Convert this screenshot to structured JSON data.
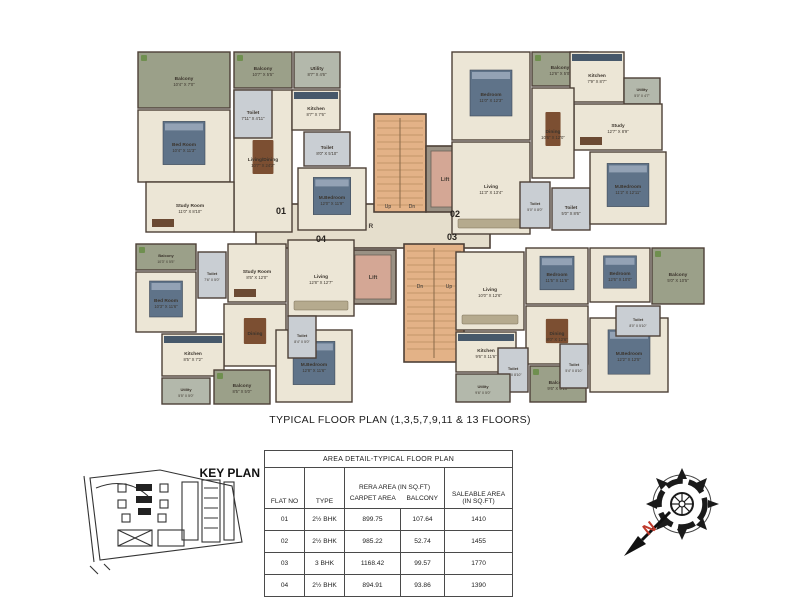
{
  "caption": "TYPICAL FLOOR PLAN (1,3,5,7,9,11 & 13 FLOORS)",
  "key_plan": {
    "title": "KEY PLAN"
  },
  "compass": {
    "letter": "N"
  },
  "table": {
    "title": "AREA DETAIL-TYPICAL FLOOR PLAN",
    "col_flat_no": "FLAT NO",
    "col_type": "TYPE",
    "col_rera": "RERA AREA (IN SQ.FT)",
    "col_carpet": "CARPET AREA",
    "col_balcony": "BALCONY",
    "col_saleable": "SALEABLE AREA (IN SQ.FT)",
    "rows": [
      {
        "flat_no": "01",
        "type": "2½ BHK",
        "carpet_area": "899.75",
        "balcony": "107.64",
        "saleable": "1410"
      },
      {
        "flat_no": "02",
        "type": "2½ BHK",
        "carpet_area": "985.22",
        "balcony": "52.74",
        "saleable": "1455"
      },
      {
        "flat_no": "03",
        "type": "3 BHK",
        "carpet_area": "1168.42",
        "balcony": "99.57",
        "saleable": "1770"
      },
      {
        "flat_no": "04",
        "type": "2½ BHK",
        "carpet_area": "894.91",
        "balcony": "93.86",
        "saleable": "1390"
      }
    ]
  },
  "colors": {
    "floor": "#ece6d6",
    "balcony": "#9ba089",
    "toilet": "#c9ced3",
    "utility": "#b3b8ab",
    "stairs": "#e3b287",
    "lift": "#d4a795",
    "lift_frame": "#9a9184",
    "wall": "#4d4037",
    "corridor": "#e5decc",
    "bed": "#5f7389",
    "pillow": "#93a2b5",
    "table": "#7c4f32",
    "counter": "#46586a",
    "sofa": "#b5aa8e",
    "desk": "#6b4a33",
    "plant": "#6f8f4f",
    "label": "#3b342c",
    "accent_red": "#c03a2b"
  },
  "plan": {
    "core": {
      "corridor": {
        "x": 256,
        "y": 204,
        "w": 234,
        "h": 44,
        "label": "CORRIDOR"
      },
      "stairs": [
        {
          "x": 374,
          "y": 114,
          "w": 52,
          "h": 98,
          "up": {
            "x": 388,
            "y": 208,
            "t": "Up"
          },
          "dn": {
            "x": 412,
            "y": 208,
            "t": "Dn"
          }
        },
        {
          "x": 404,
          "y": 244,
          "w": 60,
          "h": 118,
          "dn": {
            "x": 420,
            "y": 288,
            "t": "Dn"
          },
          "up": {
            "x": 449,
            "y": 288,
            "t": "Up"
          }
        }
      ],
      "lifts": [
        {
          "x": 426,
          "y": 146,
          "w": 38,
          "h": 66,
          "label": "Lift"
        },
        {
          "x": 350,
          "y": 250,
          "w": 46,
          "h": 54,
          "label": "Lift"
        }
      ]
    },
    "flats": [
      {
        "number": "01",
        "label_x": 281,
        "label_y": 214,
        "rooms": [
          {
            "name": "Living/Dining",
            "dims": "10'7\" X 24'2\"",
            "type": "floor",
            "furn": "table",
            "x": 234,
            "y": 90,
            "w": 58,
            "h": 142
          },
          {
            "name": "Balcony",
            "dims": "10'4\" X 7'0\"",
            "type": "balcony",
            "furn": null,
            "x": 138,
            "y": 52,
            "w": 92,
            "h": 56
          },
          {
            "name": "Balcony",
            "dims": "10'7\" X 5'5\"",
            "type": "balcony",
            "furn": null,
            "x": 234,
            "y": 52,
            "w": 58,
            "h": 36
          },
          {
            "name": "Utility",
            "dims": "8'7\" X 4'6\"",
            "type": "utility",
            "furn": null,
            "x": 294,
            "y": 52,
            "w": 46,
            "h": 36
          },
          {
            "name": "Kitchen",
            "dims": "8'7\" X 7'6\"",
            "type": "floor",
            "furn": "counter",
            "x": 292,
            "y": 90,
            "w": 48,
            "h": 40
          },
          {
            "name": "Toilet",
            "dims": "7'11\" X 4'11\"",
            "type": "toilet",
            "furn": null,
            "x": 234,
            "y": 90,
            "w": 38,
            "h": 48
          },
          {
            "name": "Bed Room",
            "dims": "10'4\" X 11'3\"",
            "type": "floor",
            "furn": "bed",
            "x": 138,
            "y": 110,
            "w": 92,
            "h": 72
          },
          {
            "name": "Study Room",
            "dims": "11'0\" X 8'10\"",
            "type": "floor",
            "furn": "desk",
            "x": 146,
            "y": 182,
            "w": 88,
            "h": 50
          },
          {
            "name": "Toilet",
            "dims": "8'0\" X 5'10\"",
            "type": "toilet",
            "furn": null,
            "x": 304,
            "y": 132,
            "w": 46,
            "h": 34
          },
          {
            "name": "M.Bedroom",
            "dims": "12'0\" X 11'9\"",
            "type": "floor",
            "furn": "bed",
            "x": 298,
            "y": 168,
            "w": 68,
            "h": 62
          }
        ]
      },
      {
        "number": "02",
        "label_x": 455,
        "label_y": 217,
        "rooms": [
          {
            "name": "Bedroom",
            "dims": "11'0\" X 12'3\"",
            "type": "floor",
            "furn": "bed",
            "x": 452,
            "y": 52,
            "w": 78,
            "h": 88
          },
          {
            "name": "Balcony",
            "dims": "12'6\" X 5'0\"",
            "type": "balcony",
            "furn": null,
            "x": 532,
            "y": 52,
            "w": 56,
            "h": 34
          },
          {
            "name": "Kitchen",
            "dims": "7'9\" X 8'7\"",
            "type": "floor",
            "furn": "counter",
            "x": 570,
            "y": 52,
            "w": 54,
            "h": 50
          },
          {
            "name": "Utility",
            "dims": "5'0\" X 4'7\"",
            "type": "utility",
            "furn": null,
            "x": 624,
            "y": 78,
            "w": 36,
            "h": 26
          },
          {
            "name": "Study",
            "dims": "12'7\" X 8'9\"",
            "type": "floor",
            "furn": "desk",
            "x": 574,
            "y": 104,
            "w": 88,
            "h": 46
          },
          {
            "name": "Dining",
            "dims": "10'6\" X 12'0\"",
            "type": "floor",
            "furn": "table",
            "x": 532,
            "y": 88,
            "w": 42,
            "h": 90
          },
          {
            "name": "Living",
            "dims": "11'3\" X 13'4\"",
            "type": "floor",
            "furn": "sofa",
            "x": 452,
            "y": 142,
            "w": 78,
            "h": 92
          },
          {
            "name": "Toilet",
            "dims": "5'0\" X 8'0\"",
            "type": "toilet",
            "furn": null,
            "x": 520,
            "y": 182,
            "w": 30,
            "h": 46
          },
          {
            "name": "Toilet",
            "dims": "5'0\" X 8'6\"",
            "type": "toilet",
            "furn": null,
            "x": 552,
            "y": 188,
            "w": 38,
            "h": 42
          },
          {
            "name": "M.Bedroom",
            "dims": "11'2\" X 12'11\"",
            "type": "floor",
            "furn": "bed",
            "x": 590,
            "y": 152,
            "w": 76,
            "h": 72
          }
        ]
      },
      {
        "number": "03",
        "label_x": 452,
        "label_y": 240,
        "rooms": [
          {
            "name": "Living",
            "dims": "10'0\" X 12'6\"",
            "type": "floor",
            "furn": "sofa",
            "x": 456,
            "y": 252,
            "w": 68,
            "h": 78
          },
          {
            "name": "Bedroom",
            "dims": "11'5\" X 11'6\"",
            "type": "floor",
            "furn": "bed",
            "x": 526,
            "y": 248,
            "w": 62,
            "h": 56
          },
          {
            "name": "Bedroom",
            "dims": "12'6\" X 10'0\"",
            "type": "floor",
            "furn": "bed",
            "x": 590,
            "y": 248,
            "w": 60,
            "h": 54
          },
          {
            "name": "Balcony",
            "dims": "5'0\" X 10'5\"",
            "type": "balcony",
            "furn": null,
            "x": 652,
            "y": 248,
            "w": 52,
            "h": 56
          },
          {
            "name": "Dining",
            "dims": "8'0\" X 12'6\"",
            "type": "floor",
            "furn": "table",
            "x": 526,
            "y": 306,
            "w": 62,
            "h": 58
          },
          {
            "name": "M.Bedroom",
            "dims": "12'2\" X 12'5\"",
            "type": "floor",
            "furn": "bed",
            "x": 590,
            "y": 318,
            "w": 78,
            "h": 74
          },
          {
            "name": "Toilet",
            "dims": "8'0\" X 5'10\"",
            "type": "toilet",
            "furn": null,
            "x": 616,
            "y": 306,
            "w": 44,
            "h": 30
          },
          {
            "name": "Kitchen",
            "dims": "9'6\" X 11'6\"",
            "type": "floor",
            "furn": "counter",
            "x": 456,
            "y": 332,
            "w": 60,
            "h": 40
          },
          {
            "name": "Toilet",
            "dims": "5'0\" X 8'10\"",
            "type": "toilet",
            "furn": null,
            "x": 498,
            "y": 348,
            "w": 30,
            "h": 44
          },
          {
            "name": "Utility",
            "dims": "9'6\" X 5'0\"",
            "type": "utility",
            "furn": null,
            "x": 456,
            "y": 374,
            "w": 54,
            "h": 28
          },
          {
            "name": "Balcony",
            "dims": "9'6\" X 5'10\"",
            "type": "balcony",
            "furn": null,
            "x": 530,
            "y": 366,
            "w": 56,
            "h": 36
          },
          {
            "name": "Toilet",
            "dims": "5'4\" X 8'10\"",
            "type": "toilet",
            "furn": null,
            "x": 560,
            "y": 344,
            "w": 28,
            "h": 44
          }
        ]
      },
      {
        "number": "04",
        "label_x": 321,
        "label_y": 242,
        "rooms": [
          {
            "name": "Living",
            "dims": "12'8\" X 12'7\"",
            "type": "floor",
            "furn": "sofa",
            "x": 288,
            "y": 240,
            "w": 66,
            "h": 76
          },
          {
            "name": "Study Room",
            "dims": "8'5\" X 12'0\"",
            "type": "floor",
            "furn": "desk",
            "x": 228,
            "y": 244,
            "w": 58,
            "h": 58
          },
          {
            "name": "Dining",
            "dims": "",
            "type": "floor",
            "furn": "table",
            "x": 224,
            "y": 304,
            "w": 62,
            "h": 62
          },
          {
            "name": "Balcony",
            "dims": "10'3\" X 5'5\"",
            "type": "balcony",
            "furn": null,
            "x": 136,
            "y": 244,
            "w": 60,
            "h": 26
          },
          {
            "name": "Toilet",
            "dims": "7'6\" X 5'0\"",
            "type": "toilet",
            "furn": null,
            "x": 198,
            "y": 252,
            "w": 28,
            "h": 46
          },
          {
            "name": "Bed Room",
            "dims": "10'3\" X 11'6\"",
            "type": "floor",
            "furn": "bed",
            "x": 136,
            "y": 272,
            "w": 60,
            "h": 60
          },
          {
            "name": "Kitchen",
            "dims": "8'5\" X 7'2\"",
            "type": "floor",
            "furn": "counter",
            "x": 162,
            "y": 334,
            "w": 62,
            "h": 42
          },
          {
            "name": "Utility",
            "dims": "5'5\" X 5'0\"",
            "type": "utility",
            "furn": null,
            "x": 162,
            "y": 378,
            "w": 48,
            "h": 26
          },
          {
            "name": "Balcony",
            "dims": "8'5\" X 5'0\"",
            "type": "balcony",
            "furn": null,
            "x": 214,
            "y": 370,
            "w": 56,
            "h": 34
          },
          {
            "name": "M.Bedroom",
            "dims": "12'8\" X 11'6\"",
            "type": "floor",
            "furn": "bed",
            "x": 276,
            "y": 330,
            "w": 76,
            "h": 72
          },
          {
            "name": "Toilet",
            "dims": "8'4\" X 5'0\"",
            "type": "toilet",
            "furn": null,
            "x": 288,
            "y": 316,
            "w": 28,
            "h": 42
          }
        ]
      }
    ]
  }
}
